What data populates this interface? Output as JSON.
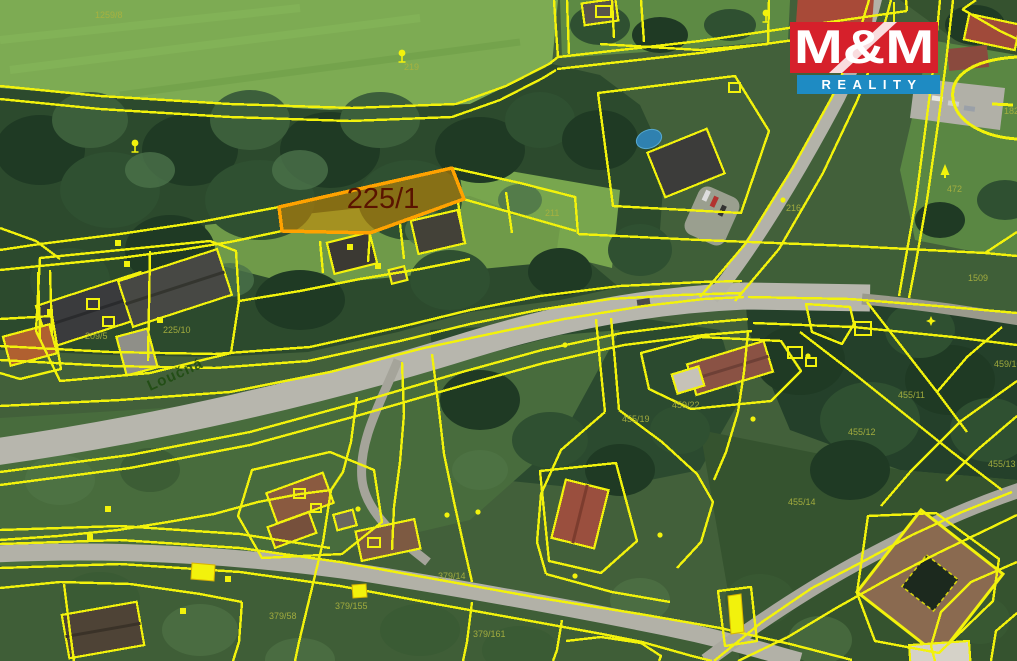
{
  "map_type": "cadastral-aerial-map",
  "logo": {
    "title": "M&M",
    "subtitle": "REALITY",
    "red": "#d6202b",
    "blue": "#1e8bc3",
    "text_color": "#ffffff"
  },
  "highlight": {
    "label": "225/1",
    "fill": "#cf8a00",
    "fill_opacity": "0.55",
    "stroke": "#ffa200",
    "label_color": "#5a1300"
  },
  "street": {
    "name": "Loučná",
    "color": "#1e4b10"
  },
  "colors": {
    "parcel_line": "#f2f20c",
    "faint_label": "#aab23f",
    "road": "#b7b6ad"
  },
  "parcel_labels": [
    {
      "t": "1259/8",
      "x": 95,
      "y": 18
    },
    {
      "t": "219",
      "x": 404,
      "y": 70
    },
    {
      "t": "211",
      "x": 545,
      "y": 216
    },
    {
      "t": "216",
      "x": 786,
      "y": 211
    },
    {
      "t": "472",
      "x": 947,
      "y": 192
    },
    {
      "t": "1509",
      "x": 968,
      "y": 281
    },
    {
      "t": "182",
      "x": 1004,
      "y": 114
    },
    {
      "t": "225/10",
      "x": 163,
      "y": 333
    },
    {
      "t": "209/5",
      "x": 85,
      "y": 339
    },
    {
      "t": "459/10",
      "x": 994,
      "y": 367
    },
    {
      "t": "455/11",
      "x": 898,
      "y": 398
    },
    {
      "t": "455/12",
      "x": 848,
      "y": 435
    },
    {
      "t": "455/13",
      "x": 988,
      "y": 467
    },
    {
      "t": "455/19",
      "x": 622,
      "y": 422
    },
    {
      "t": "459/22",
      "x": 672,
      "y": 408
    },
    {
      "t": "455/14",
      "x": 788,
      "y": 505
    },
    {
      "t": "379/155",
      "x": 335,
      "y": 609
    },
    {
      "t": "379/58",
      "x": 269,
      "y": 619
    },
    {
      "t": "379/14",
      "x": 438,
      "y": 579
    },
    {
      "t": "379/161",
      "x": 473,
      "y": 637
    }
  ],
  "symbols": [
    {
      "type": "tree",
      "x": 135,
      "y": 147
    },
    {
      "type": "tree",
      "x": 402,
      "y": 57
    },
    {
      "type": "tree",
      "x": 766,
      "y": 17
    },
    {
      "type": "conifer",
      "x": 945,
      "y": 171
    },
    {
      "type": "star",
      "x": 931,
      "y": 321
    },
    {
      "type": "dot",
      "x": 783,
      "y": 200
    },
    {
      "type": "dot",
      "x": 565,
      "y": 345
    },
    {
      "type": "dot",
      "x": 808,
      "y": 356
    },
    {
      "type": "dot",
      "x": 753,
      "y": 419
    },
    {
      "type": "dot",
      "x": 478,
      "y": 512
    },
    {
      "type": "dot",
      "x": 358,
      "y": 509
    },
    {
      "type": "dot",
      "x": 575,
      "y": 576
    },
    {
      "type": "dot",
      "x": 660,
      "y": 535
    },
    {
      "type": "dot",
      "x": 447,
      "y": 515
    },
    {
      "type": "sq",
      "x": 350,
      "y": 247
    },
    {
      "type": "sq",
      "x": 378,
      "y": 266
    },
    {
      "type": "sq",
      "x": 118,
      "y": 243
    },
    {
      "type": "sq",
      "x": 127,
      "y": 264
    },
    {
      "type": "sq",
      "x": 160,
      "y": 320
    },
    {
      "type": "sq",
      "x": 108,
      "y": 509
    },
    {
      "type": "sq",
      "x": 90,
      "y": 537
    },
    {
      "type": "sq",
      "x": 183,
      "y": 611
    },
    {
      "type": "sq",
      "x": 228,
      "y": 579
    },
    {
      "type": "sq",
      "x": 50,
      "y": 312
    },
    {
      "type": "sqo",
      "x": 855,
      "y": 322,
      "w": 16,
      "h": 13
    },
    {
      "type": "sqo",
      "x": 596,
      "y": 6,
      "w": 15,
      "h": 11
    },
    {
      "type": "sqo",
      "x": 729,
      "y": 83,
      "w": 11,
      "h": 9
    },
    {
      "type": "sqo",
      "x": 294,
      "y": 489,
      "w": 11,
      "h": 9
    },
    {
      "type": "sqo",
      "x": 311,
      "y": 504,
      "w": 10,
      "h": 8
    },
    {
      "type": "sqo",
      "x": 368,
      "y": 538,
      "w": 12,
      "h": 9
    },
    {
      "type": "sqo",
      "x": 87,
      "y": 299,
      "w": 12,
      "h": 10
    },
    {
      "type": "sqo",
      "x": 103,
      "y": 317,
      "w": 11,
      "h": 9
    },
    {
      "type": "sqo",
      "x": 788,
      "y": 347,
      "w": 14,
      "h": 11
    },
    {
      "type": "sqo",
      "x": 806,
      "y": 358,
      "w": 10,
      "h": 8
    }
  ]
}
